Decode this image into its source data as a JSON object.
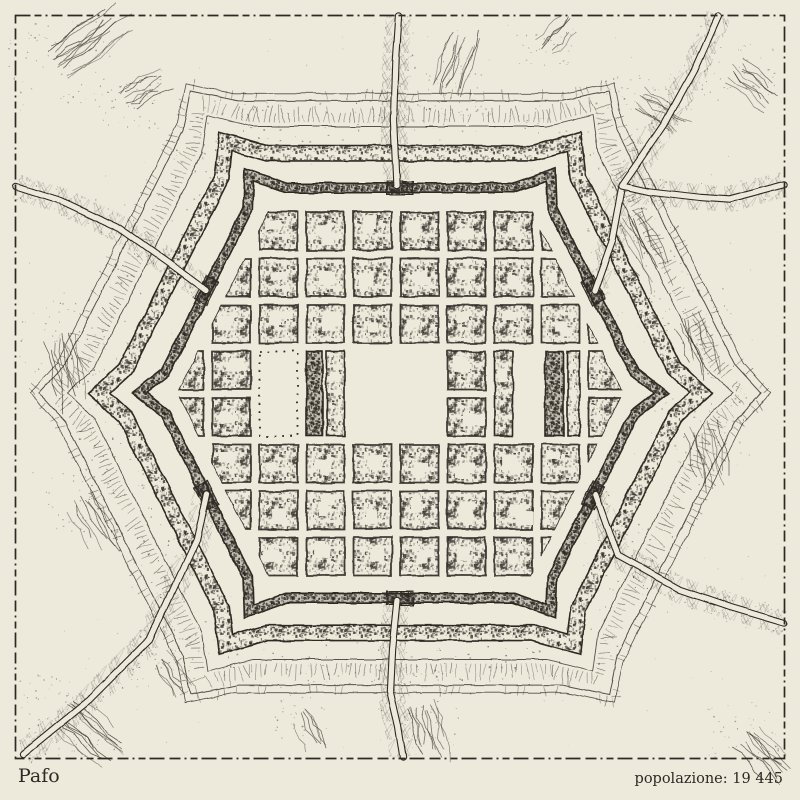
{
  "caption": {
    "title": "Pafo",
    "population_text": "popolazione: 19 445"
  },
  "palette": {
    "paper": "#EDE9DB",
    "ink": "#2D2A24",
    "soft": "#555047"
  },
  "map": {
    "seed": 1971,
    "center": {
      "x": 400,
      "y": 393
    },
    "hex_corners": [
      [
        -245,
        0
      ],
      [
        -142,
        -205
      ],
      [
        142,
        -205
      ],
      [
        245,
        0
      ],
      [
        142,
        205
      ],
      [
        -142,
        205
      ]
    ],
    "rings": {
      "clip_scale": 0.912,
      "rampart": {
        "scale": 1.0,
        "spike": 16,
        "width": 11,
        "core": 7.6
      },
      "moat": {
        "scale": 1.17,
        "spike": 14,
        "width": 17,
        "core": 13.8
      },
      "glacis_contours": [
        {
          "scale": 1.3,
          "spike": 14,
          "w": 0.9
        },
        {
          "scale": 1.425,
          "spike": 12,
          "w": 1.0
        },
        {
          "scale": 1.462,
          "spike": 12,
          "w": 0.8
        }
      ],
      "fringe": [
        {
          "scale": 1.33,
          "min": 6,
          "max": 16,
          "step": 5,
          "prob": 0.92
        },
        {
          "scale": 1.44,
          "min": 4,
          "max": 9,
          "step": 6.5,
          "prob": 0.45
        }
      ],
      "speckle_between": [
        1.19,
        1.435
      ]
    },
    "grid": {
      "col0": 165.5,
      "row0": 212,
      "pitch_x": 47,
      "pitch_y": 46.5,
      "block_w": 38,
      "block_h": 38,
      "cols": 10,
      "rows": 8
    },
    "features": {
      "plaza": {
        "x": 349,
        "y": 348,
        "w": 94,
        "h": 90
      },
      "park": {
        "x": 259.5,
        "y": 351.5,
        "w": 38,
        "h": 84.5
      },
      "dark_blocks": [
        {
          "x": 306.5,
          "y": 351.5,
          "w": 16,
          "h": 84.5
        },
        {
          "x": 545.5,
          "y": 351.5,
          "w": 18,
          "h": 84.5
        }
      ],
      "thin_blocks": [
        {
          "x": 326.5,
          "y": 351.5,
          "w": 18,
          "h": 84.5
        },
        {
          "x": 494.5,
          "y": 351.5,
          "w": 18,
          "h": 84.5
        },
        {
          "x": 567.5,
          "y": 351.5,
          "w": 12,
          "h": 84.5
        }
      ],
      "gaps": [
        {
          "x": 516.5,
          "y": 348,
          "w": 25,
          "h": 90
        }
      ]
    },
    "roads": [
      {
        "name": "north-road",
        "pts": [
          [
            397,
            186
          ],
          [
            394,
            120
          ],
          [
            396,
            60
          ],
          [
            399,
            16
          ]
        ]
      },
      {
        "name": "south-road",
        "pts": [
          [
            397,
            600
          ],
          [
            392,
            650
          ],
          [
            390,
            690
          ],
          [
            398,
            725
          ],
          [
            403,
            757
          ]
        ]
      },
      {
        "name": "northwest-road",
        "pts": [
          [
            206,
            290
          ],
          [
            168,
            262
          ],
          [
            120,
            228
          ],
          [
            60,
            200
          ],
          [
            16,
            186
          ]
        ]
      },
      {
        "name": "southwest-road",
        "pts": [
          [
            206,
            493
          ],
          [
            196,
            540
          ],
          [
            150,
            640
          ],
          [
            90,
            700
          ],
          [
            24,
            754
          ]
        ]
      },
      {
        "name": "southeast-road",
        "pts": [
          [
            596,
            494
          ],
          [
            618,
            556
          ],
          [
            680,
            590
          ],
          [
            730,
            607
          ],
          [
            784,
            623
          ]
        ]
      },
      {
        "name": "northeast-spur",
        "pts": [
          [
            594,
            291
          ],
          [
            612,
            240
          ],
          [
            622,
            186
          ]
        ]
      },
      {
        "name": "northeast-bypass",
        "pts": [
          [
            718,
            16
          ],
          [
            694,
            70
          ],
          [
            664,
            125
          ],
          [
            638,
            163
          ],
          [
            622,
            186
          ],
          [
            648,
            192
          ],
          [
            700,
            198
          ],
          [
            728,
            200
          ],
          [
            758,
            192
          ],
          [
            784,
            185
          ]
        ]
      }
    ],
    "hatch_clusters": [
      {
        "x": 60,
        "y": 65,
        "a": -38,
        "n": 13,
        "len": 75
      },
      {
        "x": 130,
        "y": 100,
        "a": -30,
        "n": 8,
        "len": 45
      },
      {
        "x": 735,
        "y": 70,
        "a": 40,
        "n": 9,
        "len": 55
      },
      {
        "x": 640,
        "y": 100,
        "a": 35,
        "n": 8,
        "len": 50
      },
      {
        "x": 628,
        "y": 220,
        "a": 62,
        "n": 10,
        "len": 70
      },
      {
        "x": 688,
        "y": 320,
        "a": 72,
        "n": 9,
        "len": 60
      },
      {
        "x": 700,
        "y": 430,
        "a": 78,
        "n": 10,
        "len": 70
      },
      {
        "x": 60,
        "y": 340,
        "a": 80,
        "n": 9,
        "len": 65
      },
      {
        "x": 80,
        "y": 500,
        "a": 60,
        "n": 8,
        "len": 55
      },
      {
        "x": 65,
        "y": 715,
        "a": 42,
        "n": 12,
        "len": 70
      },
      {
        "x": 160,
        "y": 660,
        "a": 55,
        "n": 7,
        "len": 45
      },
      {
        "x": 420,
        "y": 705,
        "a": 75,
        "n": 10,
        "len": 60
      },
      {
        "x": 300,
        "y": 715,
        "a": 65,
        "n": 6,
        "len": 40
      },
      {
        "x": 745,
        "y": 735,
        "a": 45,
        "n": 9,
        "len": 55
      },
      {
        "x": 448,
        "y": 90,
        "a": -70,
        "n": 11,
        "len": 60
      },
      {
        "x": 545,
        "y": 50,
        "a": -45,
        "n": 6,
        "len": 40
      }
    ],
    "frame": {
      "x": 15.5,
      "y": 15.5,
      "w": 769,
      "h": 743
    }
  }
}
